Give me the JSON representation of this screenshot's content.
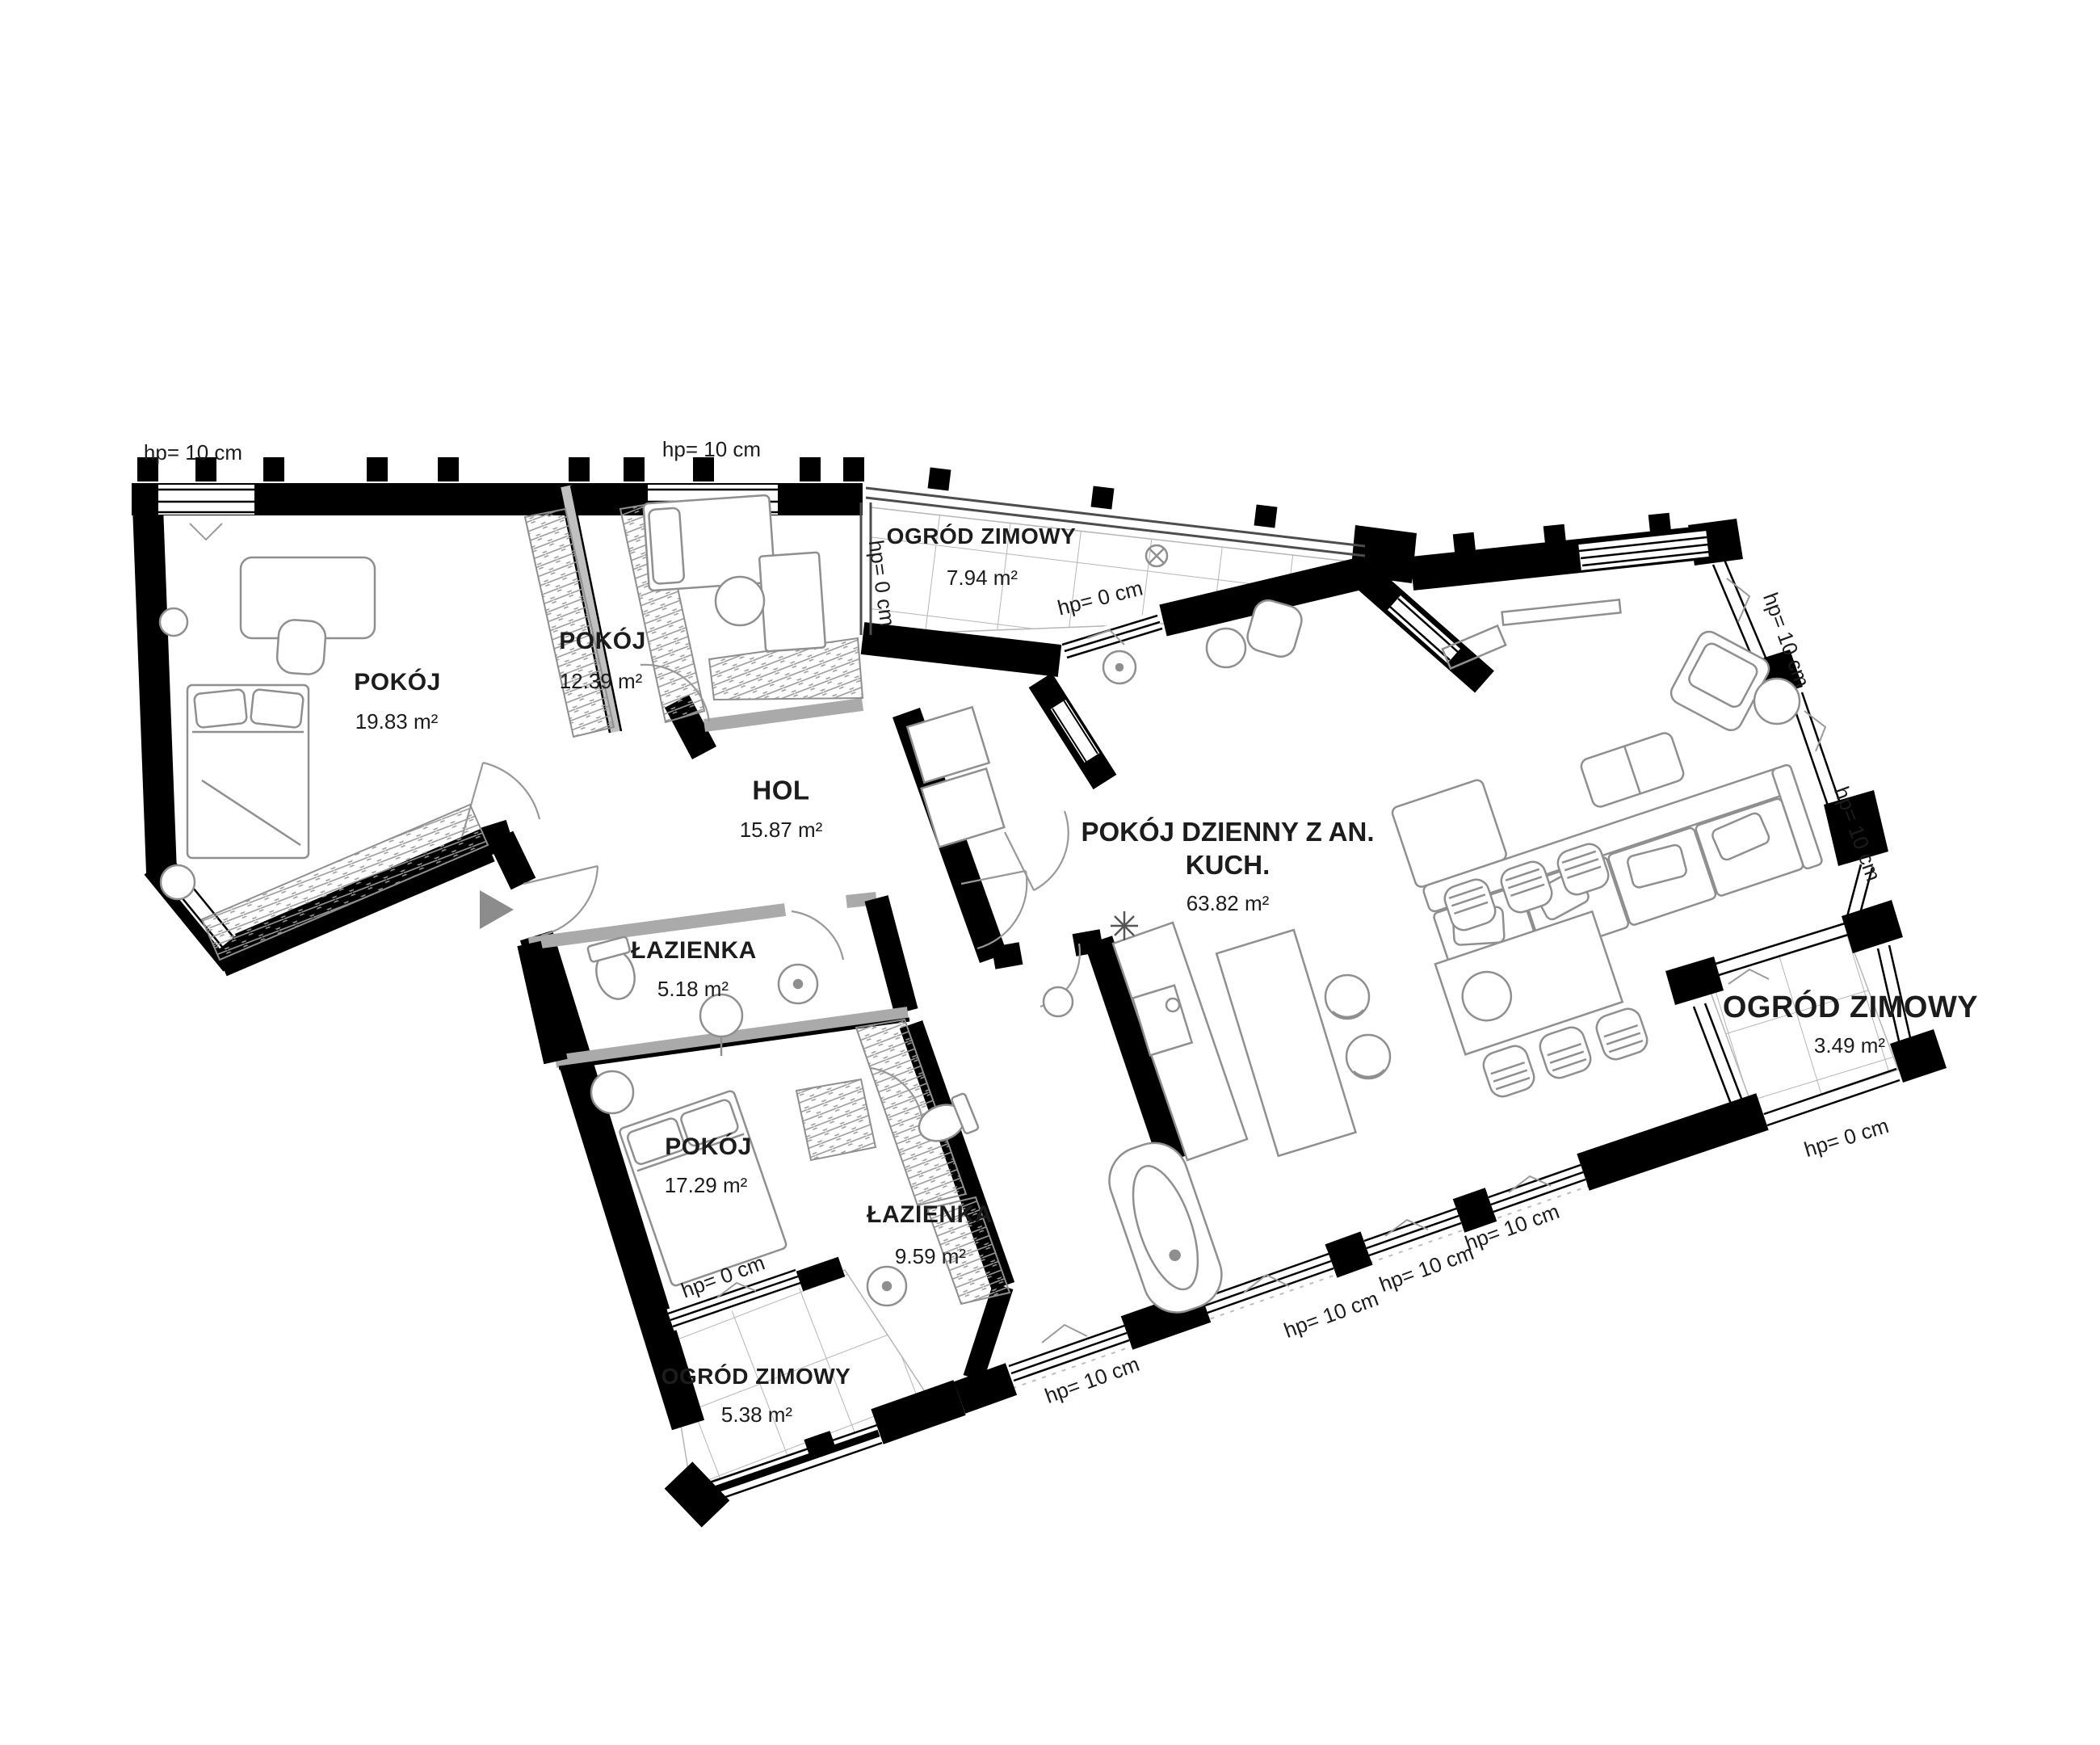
{
  "rooms": [
    {
      "id": "pokoj-1",
      "name": "POKÓJ",
      "area": "19.83 m²"
    },
    {
      "id": "pokoj-2",
      "name": "POKÓJ",
      "area": "12.39 m²"
    },
    {
      "id": "hol",
      "name": "HOL",
      "area": "15.87 m²"
    },
    {
      "id": "lazienka-1",
      "name": "ŁAZIENKA",
      "area": "5.18 m²"
    },
    {
      "id": "pokoj-3",
      "name": "POKÓJ",
      "area": "17.29 m²"
    },
    {
      "id": "lazienka-2",
      "name": "ŁAZIENKA",
      "area": "9.59 m²"
    },
    {
      "id": "ogrod-zimowy-gorny",
      "name": "OGRÓD ZIMOWY",
      "area": "7.94 m²"
    },
    {
      "id": "pokoj-dzienny",
      "name": "POKÓJ DZIENNY Z AN.",
      "name_line2": "KUCH.",
      "area": "63.82 m²"
    },
    {
      "id": "ogrod-zimowy-prawy",
      "name": "OGRÓD ZIMOWY",
      "area": "3.49 m²"
    },
    {
      "id": "ogrod-zimowy-dolny",
      "name": "OGRÓD ZIMOWY",
      "area": "5.38 m²"
    }
  ],
  "sills": [
    {
      "text": "hp= 10 cm"
    },
    {
      "text": "hp= 10 cm"
    },
    {
      "text": "hp= 0 cm"
    },
    {
      "text": "hp= 0 cm"
    },
    {
      "text": "hp= 10 cm"
    },
    {
      "text": "hp= 10 cm"
    },
    {
      "text": "hp= 0 cm"
    },
    {
      "text": "hp= 10 cm"
    },
    {
      "text": "hp= 10 cm"
    },
    {
      "text": "hp= 10 cm"
    },
    {
      "text": "hp= 10 cm"
    },
    {
      "text": "hp= 0 cm"
    }
  ],
  "colors": {
    "wall": "#000000",
    "furniture": "#8f8f8f",
    "glass": "#4d4d4d",
    "tile_grid": "#b5b5b5",
    "entrance_arrow": "#8c8c8c",
    "text": "#1c1c1c",
    "background": "#ffffff"
  }
}
